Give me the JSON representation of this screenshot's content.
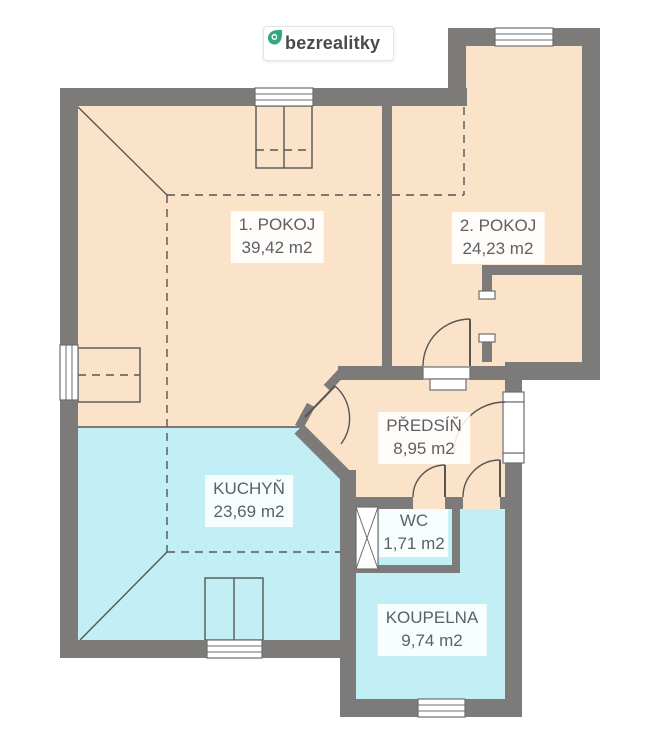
{
  "logo": {
    "text": "bezrealitky",
    "icon": "location-pin-icon",
    "icon_color": "#35a77c"
  },
  "rooms": [
    {
      "name": "1. POKOJ",
      "area": "39,42 m2",
      "fill": "warm"
    },
    {
      "name": "2. POKOJ",
      "area": "24,23 m2",
      "fill": "warm"
    },
    {
      "name": "PŘEDSÍŇ",
      "area": "8,95 m2",
      "fill": "warm"
    },
    {
      "name": "KUCHYŇ",
      "area": "23,69 m2",
      "fill": "cool"
    },
    {
      "name": "WC",
      "area": "1,71 m2",
      "fill": "cool"
    },
    {
      "name": "KOUPELNA",
      "area": "9,74 m2",
      "fill": "cool"
    }
  ],
  "colors": {
    "wall": "#7c7b79",
    "room_warm": "#fae3c8",
    "room_cool": "#c1eff5",
    "line": "#565656",
    "window_line": "#6e6e6e",
    "label_text": "#5c6166",
    "logo_text": "#4a4a4a",
    "logo_green": "#35a77c"
  }
}
